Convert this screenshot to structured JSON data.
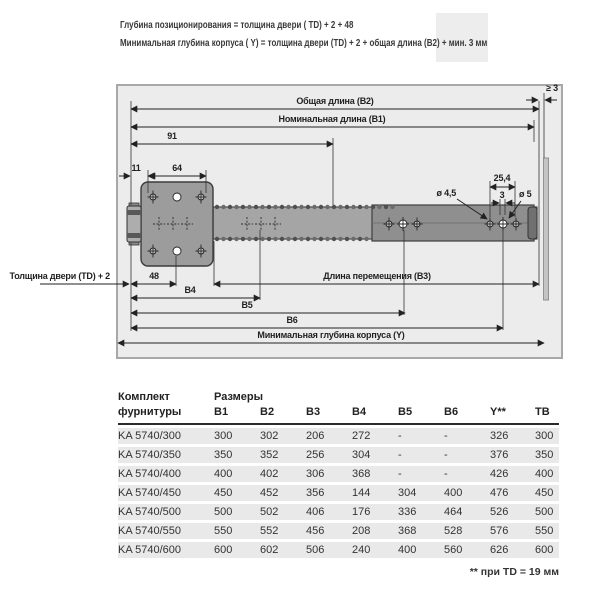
{
  "notes": {
    "line1": "Глубина позиционирования = толщина двери ( TD) + 2 + 48",
    "line2": "Минимальная глубина корпуса ( Y) = толщина двери (TD) + 2 + общая длина (B2) + мин. 3 мм"
  },
  "diagram": {
    "labels": {
      "b2": "Общая длина (B2)",
      "b1": "Номинальная длина (B1)",
      "dim91": "91",
      "dim11": "11",
      "dim64": "64",
      "ge3": "≥ 3",
      "dim254": "25,4",
      "dim3": "3",
      "dia45": "ø 4,5",
      "dia5": "ø 5",
      "door": "Толщина двери (TD) + 2",
      "dim48": "48",
      "b3": "Длина перемещения (B3)",
      "b4": "B4",
      "b5": "B5",
      "b6": "B6",
      "y": "Минимальная глубина корпуса (Y)"
    }
  },
  "table": {
    "name_header_line1": "Комплект",
    "name_header_line2": "фурнитуры",
    "col_group_label": "Размеры",
    "columns": [
      "B1",
      "B2",
      "B3",
      "B4",
      "B5",
      "B6",
      "Y**",
      "TB"
    ],
    "rows": [
      [
        "KA 5740/300",
        "300",
        "302",
        "206",
        "272",
        "-",
        "-",
        "326",
        "300"
      ],
      [
        "KA 5740/350",
        "350",
        "352",
        "256",
        "304",
        "-",
        "-",
        "376",
        "350"
      ],
      [
        "KA 5740/400",
        "400",
        "402",
        "306",
        "368",
        "-",
        "-",
        "426",
        "400"
      ],
      [
        "KA 5740/450",
        "450",
        "452",
        "356",
        "144",
        "304",
        "400",
        "476",
        "450"
      ],
      [
        "KA 5740/500",
        "500",
        "502",
        "406",
        "176",
        "336",
        "464",
        "526",
        "500"
      ],
      [
        "KA 5740/550",
        "550",
        "552",
        "456",
        "208",
        "368",
        "528",
        "576",
        "550"
      ],
      [
        "KA 5740/600",
        "600",
        "602",
        "506",
        "240",
        "400",
        "560",
        "626",
        "600"
      ]
    ]
  },
  "footnote": "** при TD = 19 мм",
  "colors": {
    "cabinet_fill": "#ececec",
    "plate_fill": "#9c9c9c",
    "rail_fill": "#a5a5a5",
    "inner_rail_fill": "#8f8f8f",
    "wall_fill": "#c4c4c4",
    "table_row_band": "#e9e9e9",
    "text": "#2e2e2e"
  }
}
